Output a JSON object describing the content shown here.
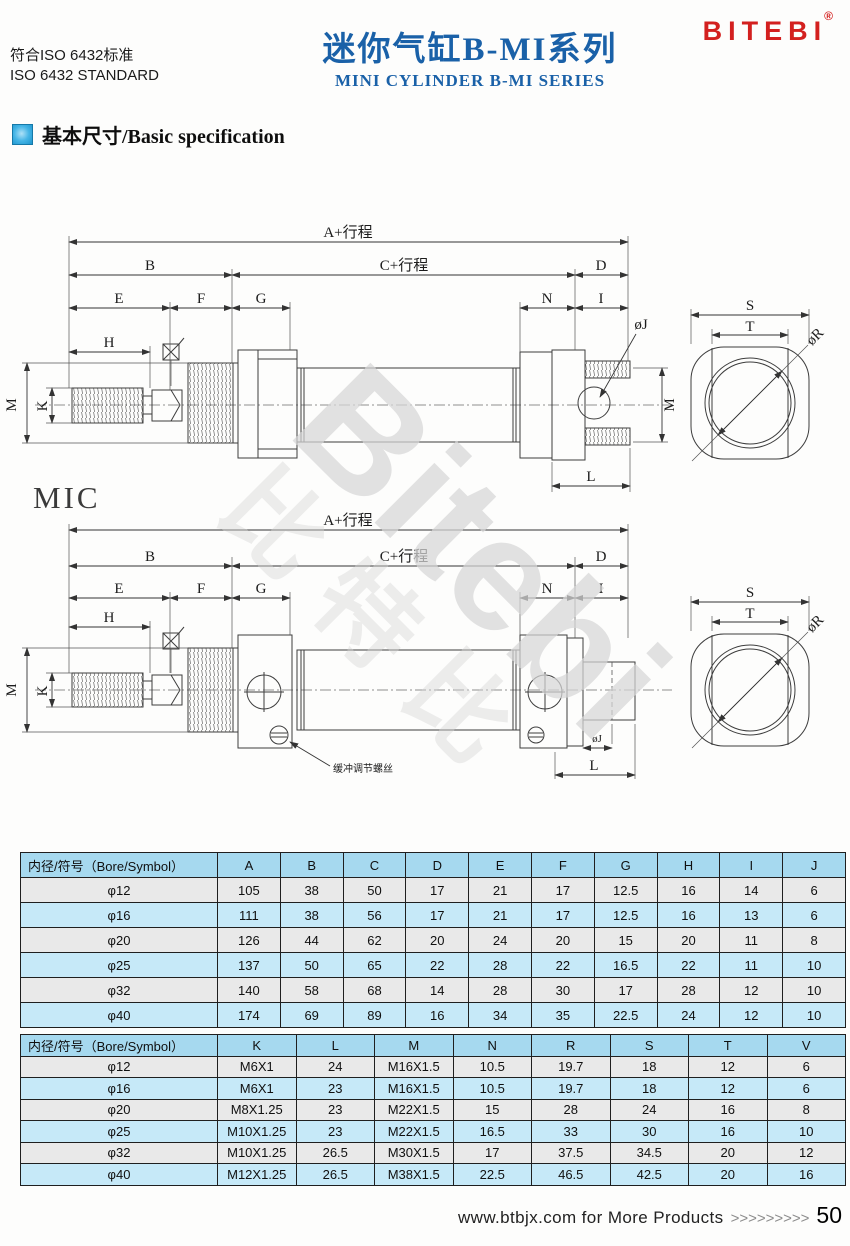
{
  "header": {
    "standard_cn": "符合ISO 6432标准",
    "standard_en": "ISO 6432 STANDARD",
    "title_cn": "迷你气缸B-MI系列",
    "title_en": "MINI CYLINDER B-MI SERIES",
    "brand": "BITEBI",
    "registered_mark": "®"
  },
  "section": {
    "heading": "基本尺寸/Basic specification"
  },
  "drawings": {
    "model_label": "MIC",
    "watermark_en": "Bitebi",
    "watermark_cn": "比特比",
    "cushion_screw_note": "缓冲调节螺丝",
    "dim": {
      "a": "A+行程",
      "b": "B",
      "c": "C+行程",
      "d": "D",
      "e": "E",
      "f": "F",
      "g": "G",
      "h": "H",
      "i": "I",
      "n": "N",
      "j": "øJ",
      "m": "M",
      "k": "K",
      "l": "L",
      "s": "S",
      "t": "T",
      "r": "øR"
    }
  },
  "tables": [
    {
      "header": [
        "内径/符号（Bore/Symbol）",
        "A",
        "B",
        "C",
        "D",
        "E",
        "F",
        "G",
        "H",
        "I",
        "J"
      ],
      "rows": [
        [
          "φ12",
          "105",
          "38",
          "50",
          "17",
          "21",
          "17",
          "12.5",
          "16",
          "14",
          "6"
        ],
        [
          "φ16",
          "111",
          "38",
          "56",
          "17",
          "21",
          "17",
          "12.5",
          "16",
          "13",
          "6"
        ],
        [
          "φ20",
          "126",
          "44",
          "62",
          "20",
          "24",
          "20",
          "15",
          "20",
          "11",
          "8"
        ],
        [
          "φ25",
          "137",
          "50",
          "65",
          "22",
          "28",
          "22",
          "16.5",
          "22",
          "11",
          "10"
        ],
        [
          "φ32",
          "140",
          "58",
          "68",
          "14",
          "28",
          "30",
          "17",
          "28",
          "12",
          "10"
        ],
        [
          "φ40",
          "174",
          "69",
          "89",
          "16",
          "34",
          "35",
          "22.5",
          "24",
          "12",
          "10"
        ]
      ]
    },
    {
      "header": [
        "内径/符号（Bore/Symbol）",
        "K",
        "L",
        "M",
        "N",
        "R",
        "S",
        "T",
        "V"
      ],
      "rows": [
        [
          "φ12",
          "M6X1",
          "24",
          "M16X1.5",
          "10.5",
          "19.7",
          "18",
          "12",
          "6"
        ],
        [
          "φ16",
          "M6X1",
          "23",
          "M16X1.5",
          "10.5",
          "19.7",
          "18",
          "12",
          "6"
        ],
        [
          "φ20",
          "M8X1.25",
          "23",
          "M22X1.5",
          "15",
          "28",
          "24",
          "16",
          "8"
        ],
        [
          "φ25",
          "M10X1.25",
          "23",
          "M22X1.5",
          "16.5",
          "33",
          "30",
          "16",
          "10"
        ],
        [
          "φ32",
          "M10X1.25",
          "26.5",
          "M30X1.5",
          "17",
          "37.5",
          "34.5",
          "20",
          "12"
        ],
        [
          "φ40",
          "M12X1.25",
          "26.5",
          "M38X1.5",
          "22.5",
          "46.5",
          "42.5",
          "20",
          "16"
        ]
      ]
    }
  ],
  "footer": {
    "text": "www.btbjx.com for More Products",
    "chevrons": ">>>>>>>>>",
    "page": "50"
  },
  "colors": {
    "accent_blue": "#1a61a8",
    "brand_red": "#d3201f",
    "table_header_bg": "#a6d9ef",
    "row_alt_gray": "#e9e9e9",
    "row_alt_cyan": "#c6e9f8"
  }
}
